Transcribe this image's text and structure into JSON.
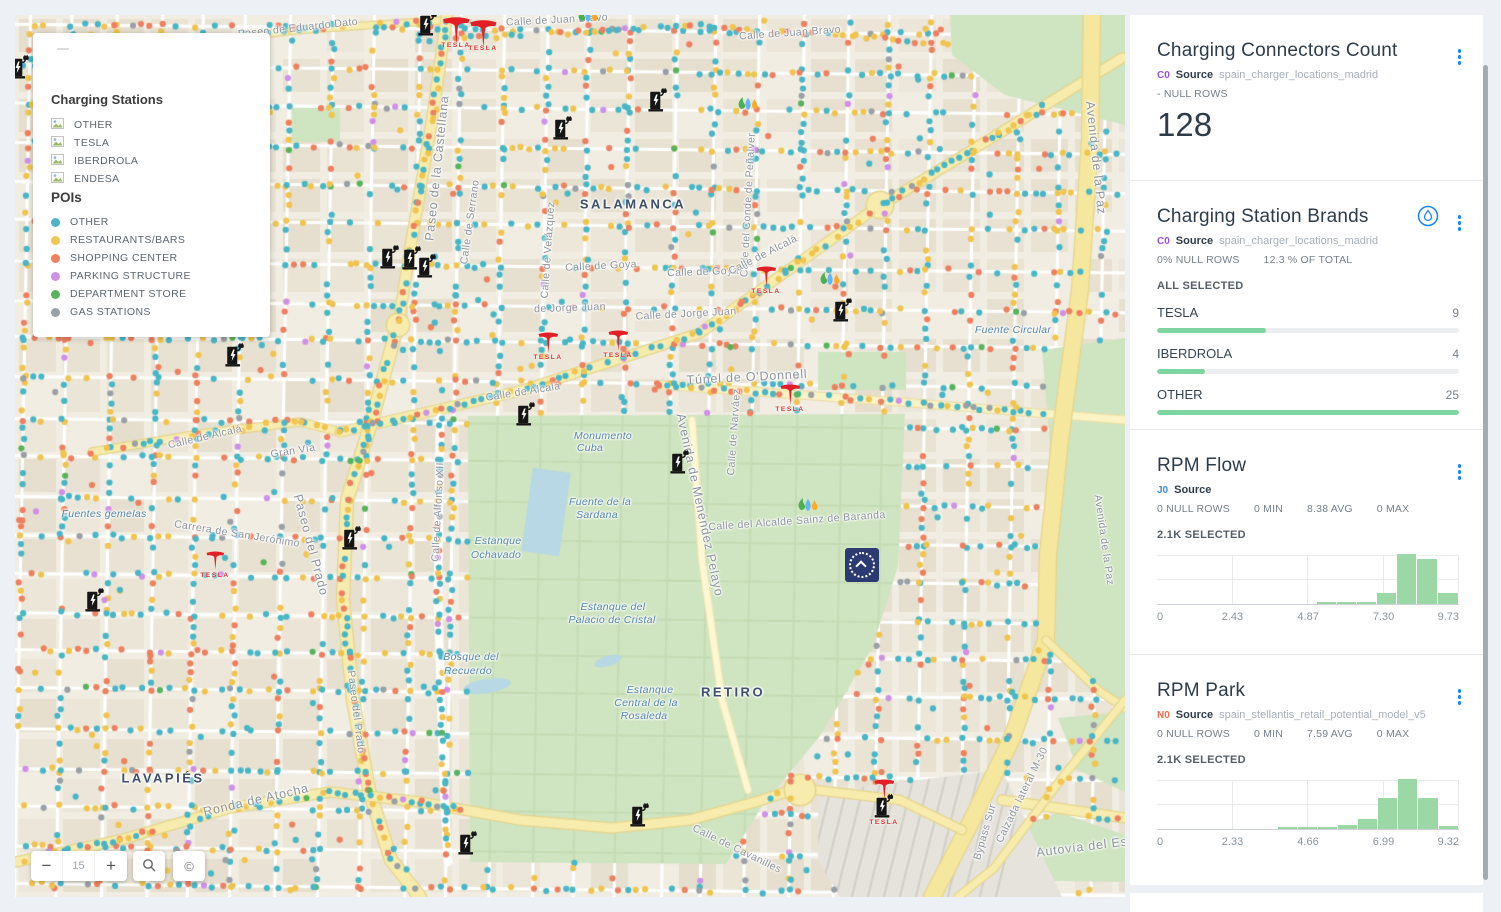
{
  "map": {
    "legend": {
      "title": "Charging Stations",
      "station_items": [
        "OTHER",
        "TESLA",
        "IBERDROLA",
        "ENDESA"
      ],
      "pois_title": "POIs",
      "poi_items": [
        {
          "label": "OTHER",
          "color": "#4ab5c6"
        },
        {
          "label": "RESTAURANTS/BARS",
          "color": "#efc74e"
        },
        {
          "label": "SHOPPING CENTER",
          "color": "#ee8060"
        },
        {
          "label": "PARKING STRUCTURE",
          "color": "#cf90e8"
        },
        {
          "label": "DEPARTMENT STORE",
          "color": "#57b45c"
        },
        {
          "label": "GAS STATIONS",
          "color": "#9aa0a6"
        }
      ]
    },
    "controls": {
      "zoom_out": "−",
      "zoom_level": "15",
      "zoom_in": "+",
      "copyright": "©"
    },
    "dot_palette": [
      "#49b6c6",
      "#f0c44f",
      "#ee8060",
      "#cf90e8",
      "#57b45c",
      "#9aa0a6"
    ],
    "labels": [
      {
        "t": "Paseo de Eduardo Dato",
        "x": 298,
        "y": 28,
        "r": -6,
        "c": "street"
      },
      {
        "t": "Calle de Juan Bravo",
        "x": 557,
        "y": 20,
        "r": -3,
        "c": "street"
      },
      {
        "t": "Calle de Juan Bravo",
        "x": 790,
        "y": 33,
        "r": -4,
        "c": "street"
      },
      {
        "t": "Paseo de la Castellana",
        "x": 437,
        "y": 168,
        "r": -84,
        "c": "street-big"
      },
      {
        "t": "Calle de Serrano",
        "x": 470,
        "y": 222,
        "r": -82,
        "c": "street"
      },
      {
        "t": "Calle de Velázquez",
        "x": 548,
        "y": 250,
        "r": -86,
        "c": "street"
      },
      {
        "t": "SALAMANCA",
        "x": 633,
        "y": 204,
        "r": 0,
        "c": "district"
      },
      {
        "t": "Calle del Conde de Peñalver",
        "x": 748,
        "y": 205,
        "r": -87,
        "c": "street"
      },
      {
        "t": "Calle de Goya",
        "x": 601,
        "y": 266,
        "r": -3,
        "c": "street"
      },
      {
        "t": "Calle de Goya",
        "x": 703,
        "y": 272,
        "r": -2,
        "c": "street"
      },
      {
        "t": "Calle de Alcalá",
        "x": 763,
        "y": 255,
        "r": -27,
        "c": "street"
      },
      {
        "t": "de Jorge Juan",
        "x": 570,
        "y": 308,
        "r": -2,
        "c": "street"
      },
      {
        "t": "Calle de Jorge Juan",
        "x": 686,
        "y": 314,
        "r": -3,
        "c": "street"
      },
      {
        "t": "Fuente Circular",
        "x": 1013,
        "y": 330,
        "r": 0,
        "c": "nature"
      },
      {
        "t": "Túnel de O'Donnell",
        "x": 747,
        "y": 377,
        "r": -3,
        "c": "street-big"
      },
      {
        "t": "Calle de Alcalá",
        "x": 523,
        "y": 392,
        "r": -9,
        "c": "street"
      },
      {
        "t": "Calle de Alcalá",
        "x": 205,
        "y": 437,
        "r": -13,
        "c": "street"
      },
      {
        "t": "Gran Vía",
        "x": 293,
        "y": 451,
        "r": -9,
        "c": "street"
      },
      {
        "t": "Calle de Narváez",
        "x": 734,
        "y": 432,
        "r": -86,
        "c": "street"
      },
      {
        "t": "Avenida de la Paz",
        "x": 1096,
        "y": 158,
        "r": 84,
        "c": "street-big"
      },
      {
        "t": "Avenida de la Paz",
        "x": 1104,
        "y": 540,
        "r": 82,
        "c": "street"
      },
      {
        "t": "Monumento",
        "x": 603,
        "y": 436,
        "r": 0,
        "c": "nature"
      },
      {
        "t": "Cuba",
        "x": 590,
        "y": 448,
        "r": 0,
        "c": "nature"
      },
      {
        "t": "Avenida de Menéndez Pelayo",
        "x": 700,
        "y": 505,
        "r": 78,
        "c": "street-big"
      },
      {
        "t": "Fuente de la",
        "x": 600,
        "y": 502,
        "r": 0,
        "c": "nature"
      },
      {
        "t": "Sardana",
        "x": 597,
        "y": 515,
        "r": 0,
        "c": "nature"
      },
      {
        "t": "Calle del Alcalde Sainz de Baranda",
        "x": 797,
        "y": 521,
        "r": -4,
        "c": "street"
      },
      {
        "t": "Estanque",
        "x": 498,
        "y": 541,
        "r": 0,
        "c": "nature"
      },
      {
        "t": "Ochavado",
        "x": 496,
        "y": 555,
        "r": 0,
        "c": "nature"
      },
      {
        "t": "Fuentes gemelas",
        "x": 104,
        "y": 514,
        "r": 0,
        "c": "nature"
      },
      {
        "t": "Carrera de San Jerónimo",
        "x": 237,
        "y": 534,
        "r": 9,
        "c": "street"
      },
      {
        "t": "Paseo del Prado",
        "x": 311,
        "y": 545,
        "r": 75,
        "c": "street-big"
      },
      {
        "t": "Calle de Alfonso XII",
        "x": 438,
        "y": 512,
        "r": -87,
        "c": "street"
      },
      {
        "t": "Estanque del",
        "x": 613,
        "y": 607,
        "r": 0,
        "c": "nature"
      },
      {
        "t": "Palacio de Cristal",
        "x": 612,
        "y": 620,
        "r": 0,
        "c": "nature"
      },
      {
        "t": "Bosque del",
        "x": 471,
        "y": 657,
        "r": 0,
        "c": "nature"
      },
      {
        "t": "Recuerdo",
        "x": 468,
        "y": 671,
        "r": 0,
        "c": "nature"
      },
      {
        "t": "RETIRO",
        "x": 733,
        "y": 692,
        "r": 0,
        "c": "district"
      },
      {
        "t": "Estanque",
        "x": 650,
        "y": 690,
        "r": 0,
        "c": "nature"
      },
      {
        "t": "Central de la",
        "x": 646,
        "y": 703,
        "r": 0,
        "c": "nature"
      },
      {
        "t": "Rosaleda",
        "x": 644,
        "y": 716,
        "r": 0,
        "c": "nature"
      },
      {
        "t": "Paseo del Prado",
        "x": 356,
        "y": 712,
        "r": 83,
        "c": "street"
      },
      {
        "t": "LAVAPIÉS",
        "x": 163,
        "y": 778,
        "r": 0,
        "c": "district"
      },
      {
        "t": "Ronda de Atocha",
        "x": 256,
        "y": 800,
        "r": -13,
        "c": "street-big"
      },
      {
        "t": "Calle de Cavanilles",
        "x": 737,
        "y": 849,
        "r": 26,
        "c": "street"
      },
      {
        "t": "Bypass Sur",
        "x": 985,
        "y": 832,
        "r": -74,
        "c": "street"
      },
      {
        "t": "Calzada lateral M-30",
        "x": 1022,
        "y": 795,
        "r": -64,
        "c": "street"
      },
      {
        "t": "Autovía del Es",
        "x": 1082,
        "y": 847,
        "r": -7,
        "c": "street-big"
      }
    ],
    "markers": {
      "chargers": [
        [
          20,
          67
        ],
        [
          428,
          24
        ],
        [
          563,
          128
        ],
        [
          658,
          100
        ],
        [
          390,
          257
        ],
        [
          412,
          258
        ],
        [
          427,
          266
        ],
        [
          843,
          310
        ],
        [
          235,
          355
        ],
        [
          526,
          414
        ],
        [
          680,
          462
        ],
        [
          352,
          538
        ],
        [
          95,
          600
        ],
        [
          640,
          815
        ],
        [
          468,
          843
        ]
      ],
      "teslas": [
        {
          "x": 456,
          "y": 34,
          "s": 1.35,
          "label": "TESLA"
        },
        {
          "x": 483,
          "y": 37,
          "s": 1.35,
          "label": "TESLA"
        },
        {
          "x": 766,
          "y": 280,
          "s": 1,
          "label": "TESLA"
        },
        {
          "x": 548,
          "y": 346,
          "s": 1,
          "label": "TESLA"
        },
        {
          "x": 618,
          "y": 344,
          "s": 1,
          "label": "TESLA"
        },
        {
          "x": 790,
          "y": 398,
          "s": 1,
          "label": "TESLA"
        },
        {
          "x": 215,
          "y": 564,
          "s": 0.9,
          "label": "TESLA"
        },
        {
          "x": 884,
          "y": 802,
          "s": 1,
          "label": "TESLA",
          "charger": true
        }
      ],
      "gas": [
        [
          588,
          14
        ],
        [
          748,
          102
        ],
        [
          830,
          277
        ],
        [
          808,
          503
        ]
      ],
      "venue": {
        "x": 862,
        "y": 565
      }
    }
  },
  "sidebar": {
    "widgets": [
      {
        "title": "Charging Connectors Count",
        "tag": "C0",
        "tag_color": "#9b51e0",
        "source_label": "Source",
        "source_name": "spain_charger_locations_madrid",
        "stats": [
          "- NULL ROWS"
        ],
        "value": "128"
      },
      {
        "title": "Charging Station Brands",
        "tag": "C0",
        "tag_color": "#9b51e0",
        "source_label": "Source",
        "source_name": "spain_charger_locations_madrid",
        "stats": [
          "0% NULL ROWS",
          "12.3 % OF TOTAL"
        ],
        "selection": "ALL SELECTED",
        "categories": [
          {
            "label": "TESLA",
            "value": "9",
            "pct": 36
          },
          {
            "label": "IBERDROLA",
            "value": "4",
            "pct": 16
          },
          {
            "label": "OTHER",
            "value": "25",
            "pct": 100
          }
        ]
      },
      {
        "title": "RPM Flow",
        "tag": "J0",
        "tag_color": "#3d8be8",
        "source_label": "Source",
        "source_name": "",
        "stats": [
          "0 NULL ROWS",
          "0 MIN",
          "8.38 AVG",
          "0 MAX"
        ],
        "selection": "2.1K SELECTED"
      },
      {
        "title": "RPM Park",
        "tag": "N0",
        "tag_color": "#f4704f",
        "source_label": "Source",
        "source_name": "spain_stellantis_retail_potential_model_v5",
        "stats": [
          "0 NULL ROWS",
          "0 MIN",
          "7.59 AVG",
          "0 MAX"
        ],
        "selection": "2.1K SELECTED"
      }
    ]
  },
  "chart_data": [
    {
      "type": "bar",
      "orientation": "horizontal",
      "title": "Charging Station Brands",
      "categories": [
        "TESLA",
        "IBERDROLA",
        "OTHER"
      ],
      "values": [
        9,
        4,
        25
      ],
      "bar_color": "#7fd5a2",
      "legend": false
    },
    {
      "type": "bar",
      "subtype": "histogram",
      "title": "RPM Flow",
      "xlim": [
        0,
        9.73
      ],
      "x_ticks": [
        0,
        2.43,
        4.87,
        7.3,
        9.73
      ],
      "stats": {
        "null_rows": 0,
        "min": 0,
        "avg": 8.38,
        "max": 0,
        "selected": "2.1K"
      },
      "bins": [
        {
          "x0": 5.14,
          "x1": 5.79,
          "h": 0.03
        },
        {
          "x0": 5.79,
          "x1": 6.44,
          "h": 0.03
        },
        {
          "x0": 6.44,
          "x1": 7.09,
          "h": 0.04
        },
        {
          "x0": 7.09,
          "x1": 7.74,
          "h": 0.22
        },
        {
          "x0": 7.74,
          "x1": 8.39,
          "h": 1.0
        },
        {
          "x0": 8.39,
          "x1": 9.04,
          "h": 0.9
        },
        {
          "x0": 9.04,
          "x1": 9.73,
          "h": 0.21
        }
      ],
      "bar_color": "#9cd8a5",
      "grid": true
    },
    {
      "type": "bar",
      "subtype": "histogram",
      "title": "RPM Park",
      "xlim": [
        0,
        9.32
      ],
      "x_ticks": [
        0,
        2.33,
        4.66,
        6.99,
        9.32
      ],
      "stats": {
        "null_rows": 0,
        "min": 0,
        "avg": 7.59,
        "max": 0,
        "selected": "2.1K"
      },
      "bins": [
        {
          "x0": 3.73,
          "x1": 4.35,
          "h": 0.035
        },
        {
          "x0": 4.35,
          "x1": 4.97,
          "h": 0.035
        },
        {
          "x0": 4.97,
          "x1": 5.59,
          "h": 0.04
        },
        {
          "x0": 5.59,
          "x1": 6.21,
          "h": 0.08
        },
        {
          "x0": 6.21,
          "x1": 6.83,
          "h": 0.19
        },
        {
          "x0": 6.83,
          "x1": 7.45,
          "h": 0.62
        },
        {
          "x0": 7.45,
          "x1": 8.07,
          "h": 1.0
        },
        {
          "x0": 8.07,
          "x1": 8.69,
          "h": 0.61
        },
        {
          "x0": 8.69,
          "x1": 9.32,
          "h": 0.055
        }
      ],
      "bar_color": "#9cd8a5",
      "grid": true
    }
  ]
}
